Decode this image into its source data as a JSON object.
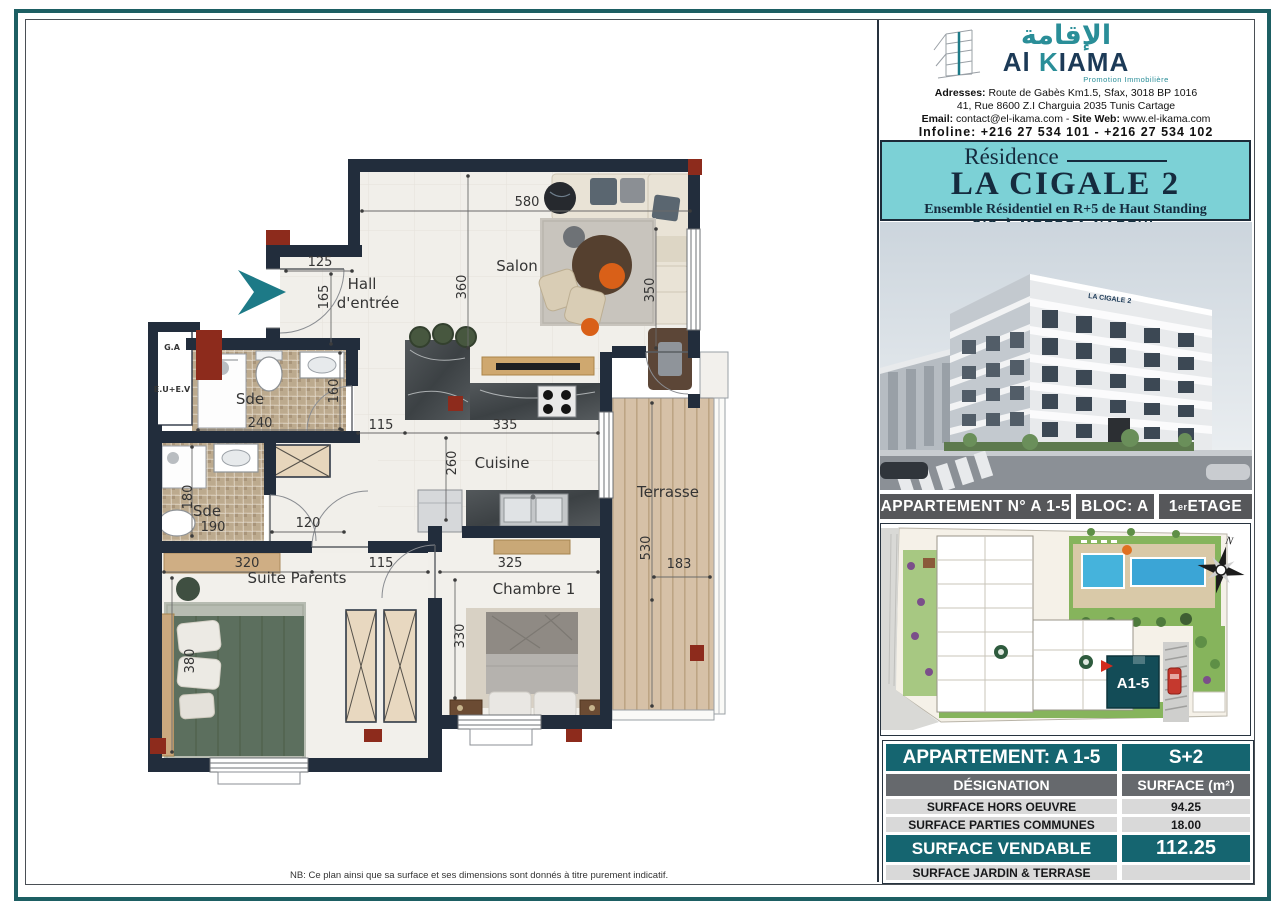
{
  "doc": {
    "note": "NB: Ce plan ainsi que sa surface et ses dimensions sont donnés à titre purement indicatif."
  },
  "colors": {
    "teal_light": "#7cd1d6",
    "teal_dark": "#156570",
    "navy": "#222d3c",
    "red_accent": "#8d2b1c",
    "bar_gray": "#56575a",
    "entrance_arrow": "#1d7a87"
  },
  "plan": {
    "rooms": {
      "hall1": "Hall",
      "hall2": "d'entrée",
      "salon": "Salon",
      "sde1": "Sde",
      "sde2": "Sde",
      "cuisine": "Cuisine",
      "terrasse": "Terrasse",
      "suite": "Suite Parents",
      "chambre1": "Chambre 1",
      "shaft_top": "G.A",
      "shaft": "E.U+E.V"
    },
    "dims": {
      "d580": "580",
      "d360": "360",
      "d350": "350",
      "d125": "125",
      "d165": "165",
      "d240": "240",
      "d160": "160",
      "d115a": "115",
      "d335": "335",
      "d260": "260",
      "d180": "180",
      "d190": "190",
      "d120": "120",
      "d320": "320",
      "d115b": "115",
      "d325": "325",
      "d380": "380",
      "d330": "330",
      "d530": "530",
      "d183": "183"
    }
  },
  "panel": {
    "logo": {
      "arabic": "الإقامة",
      "name_al": "Al ",
      "name_k": "K",
      "name_i": "I",
      "name_rest": "AMA",
      "tagline": "Promotion Immobilière"
    },
    "address": {
      "l1b": "Adresses:",
      "l1": " Route de Gabès Km1.5, Sfax, 3018 BP 1016",
      "l2": "41, Rue 8600 Z.I Charguia 2035 Tunis Cartage",
      "l3b1": "Email:",
      "l3a": " contact@el-ikama.com - ",
      "l3b2": "Site Web:",
      "l3c": " www.el-ikama.com",
      "l4b": "Infoline:",
      "l4": " +216 27 534 101 - +216 27 534 102"
    },
    "title": {
      "residence": "Résidence",
      "name": "LA CIGALE 2",
      "subtitle": "Ensemble Résidentiel en R+5 de Haut Standing",
      "location": "SIS À MREZGA-NABEUL"
    },
    "render": {
      "sign": "LA CIGALE 2"
    },
    "bar": {
      "apartment": "APPARTEMENT N° A 1-5",
      "bloc": "BLOC: A",
      "etage1": "1",
      "etage_sup": "er",
      "etage2": " ETAGE"
    },
    "siteplan": {
      "unit": "A1-5",
      "north": "N"
    }
  },
  "table": {
    "header_left": "APPARTEMENT: A 1-5",
    "header_right": "S+2",
    "sub_left": "DÉSIGNATION",
    "sub_right": "SURFACE (m²)",
    "rows": [
      {
        "label": "SURFACE HORS OEUVRE",
        "value": "94.25"
      },
      {
        "label": "SURFACE PARTIES COMMUNES",
        "value": "18.00"
      },
      {
        "label": "SURFACE VENDABLE",
        "value": "112.25"
      },
      {
        "label": "SURFACE JARDIN & TERRASE",
        "value": ""
      }
    ]
  }
}
